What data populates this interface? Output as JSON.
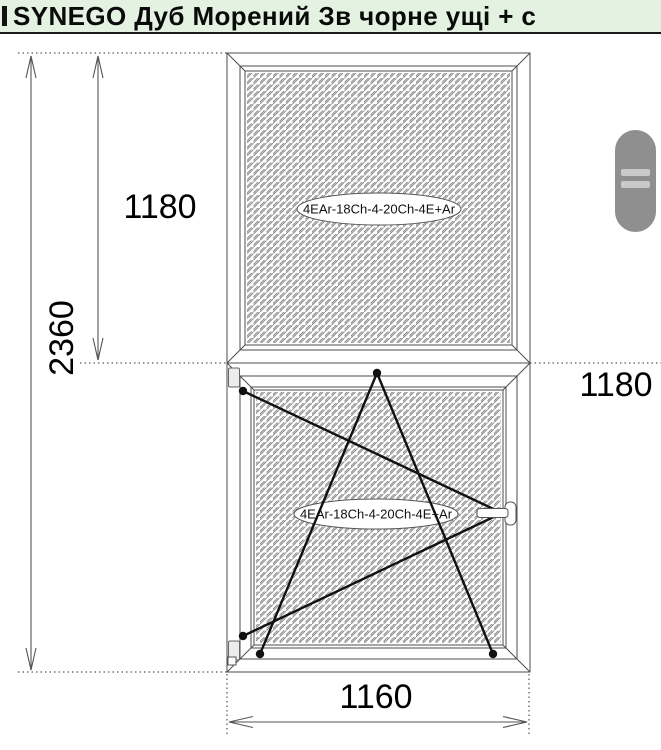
{
  "title_bar": {
    "title": "SYNEGO  Дуб Морений Зв чорне ущі + с"
  },
  "drawing": {
    "glass_label_top": "4EAr-18Ch-4-20Ch-4E+Ar",
    "glass_label_bottom": "4EAr-18Ch-4-20Ch-4E+Ar",
    "dim_total_height": "2360",
    "dim_top_section_height": "1180",
    "dim_bottom_section_height": "1180",
    "dim_width": "1160"
  },
  "colors": {
    "titlebar_bg": "#e3f2e1",
    "frame_line": "#4d4d4d",
    "hatch": "#8c8c8c",
    "opening_line": "#111111",
    "dim_line": "#555555",
    "scroll_handle": "#8f8f8f",
    "scroll_handle_bars": "#c9c9c9"
  }
}
